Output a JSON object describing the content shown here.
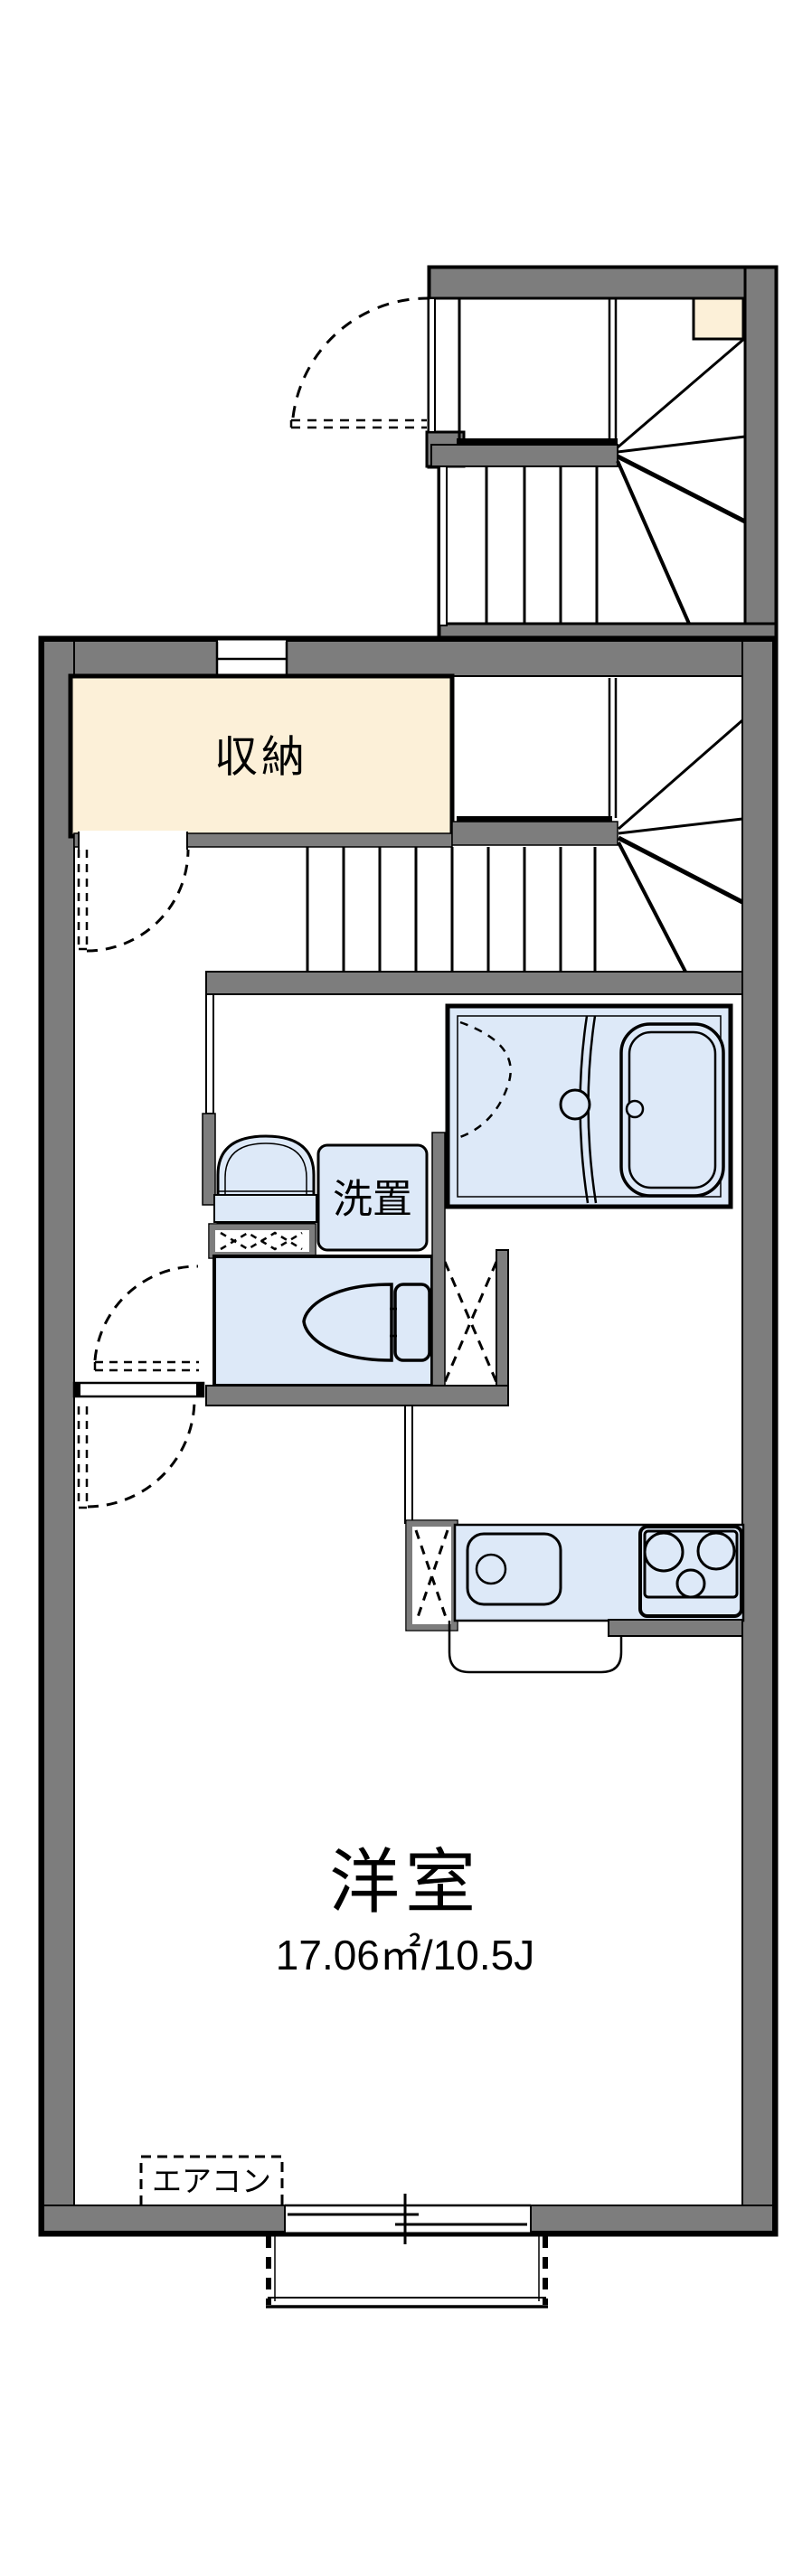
{
  "plan": {
    "type": "apartment-floor-plan",
    "labels": {
      "storage": "収納",
      "laundry": "洗置",
      "room_name": "洋室",
      "room_size": "17.06㎡/10.5J",
      "aircon": "エアコン"
    },
    "colors": {
      "wall_gray": "#7d7d7d",
      "storage_beige": "#fcf0d8",
      "wet_area_blue": "#dde9f8",
      "line_black": "#000000",
      "background": "#ffffff"
    }
  }
}
